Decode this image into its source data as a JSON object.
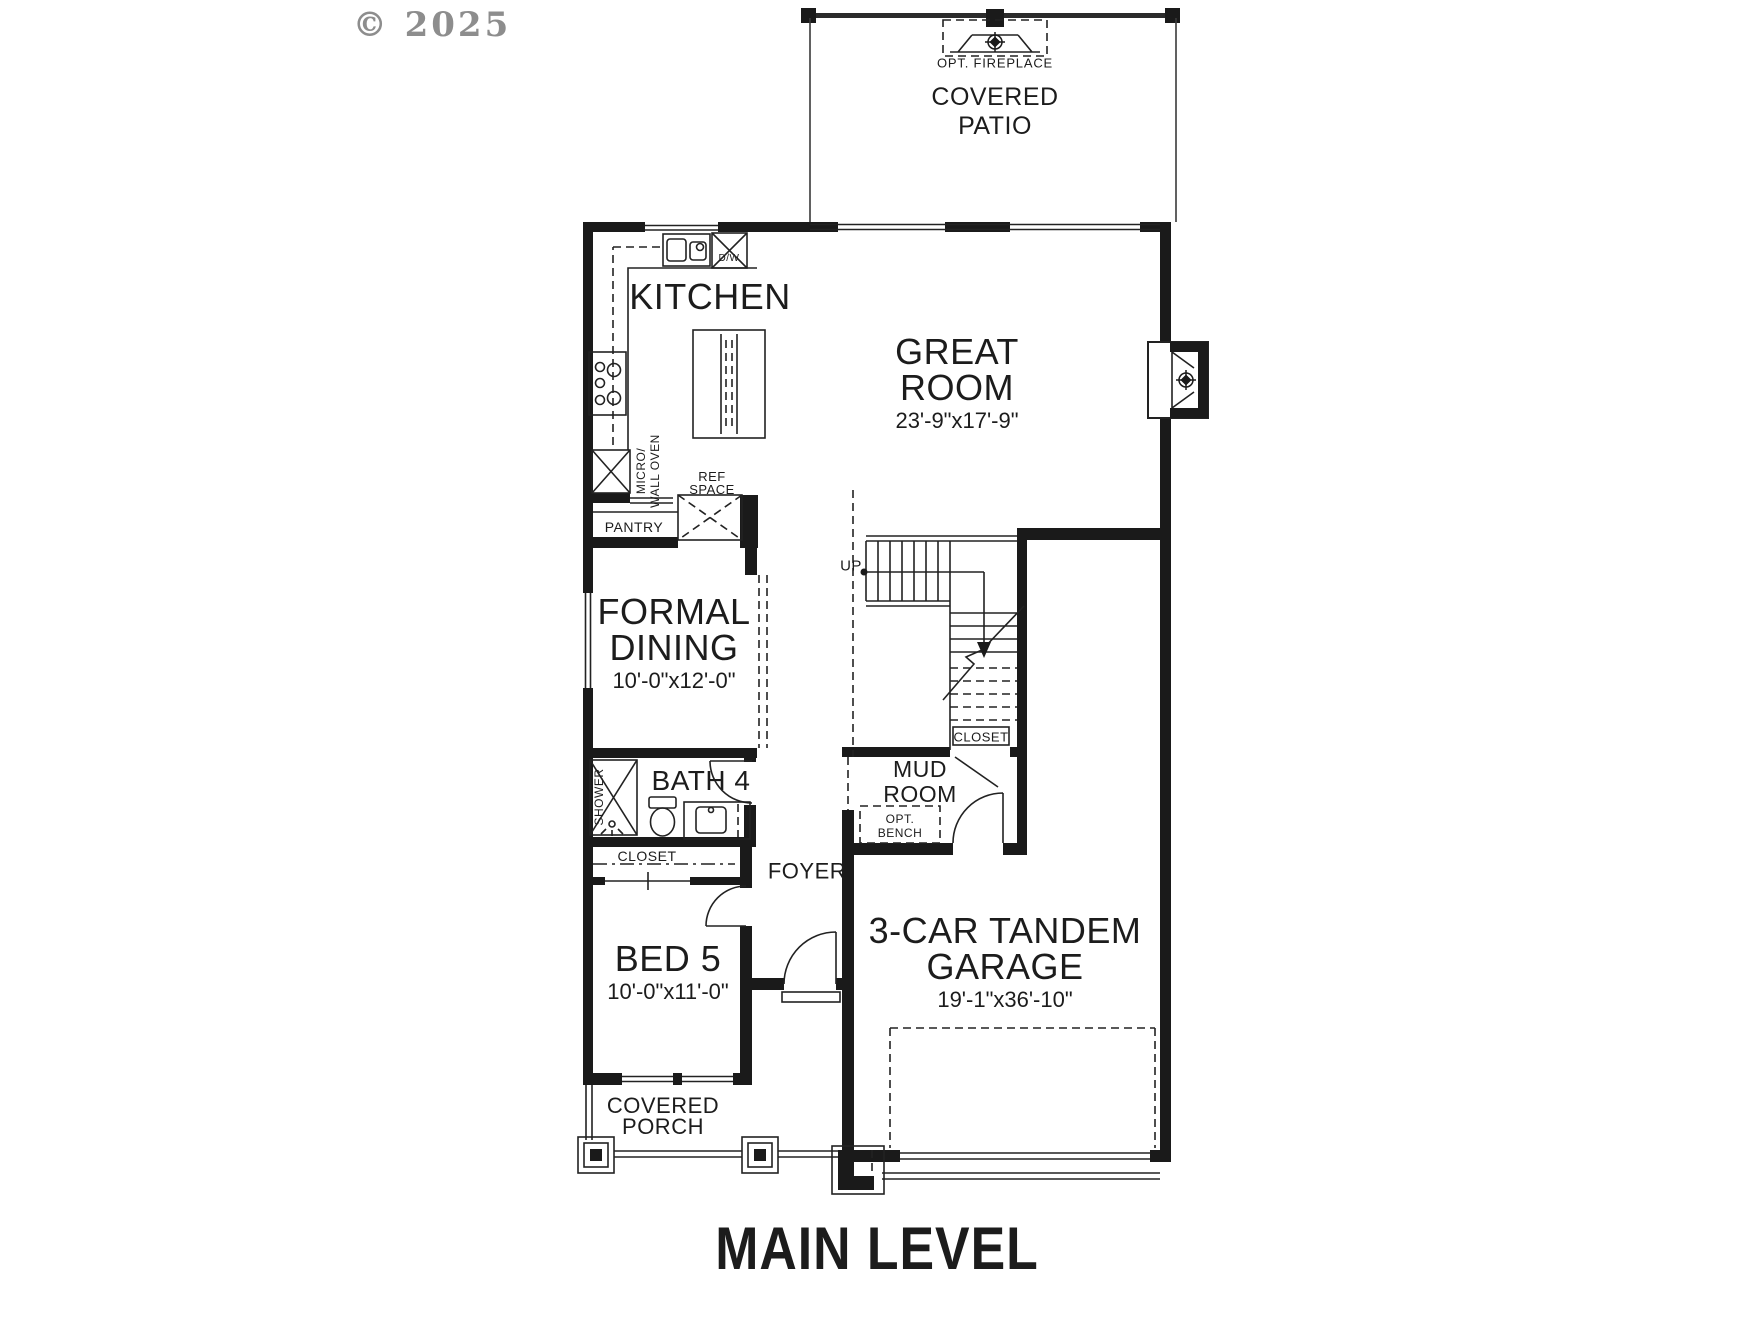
{
  "watermark": "© 2025",
  "plan_title": "MAIN LEVEL",
  "colors": {
    "line": "#1c1c1c",
    "watermark": "#8d8d8d",
    "background": "#ffffff"
  },
  "rooms": {
    "covered_patio": {
      "line1": "COVERED",
      "line2": "PATIO"
    },
    "opt_fireplace": {
      "label": "OPT. FIREPLACE"
    },
    "kitchen": {
      "name": "KITCHEN"
    },
    "great_room": {
      "line1": "GREAT",
      "line2": "ROOM",
      "dims": "23'-9\"x17'-9\""
    },
    "formal_dining": {
      "line1": "FORMAL",
      "line2": "DINING",
      "dims": "10'-0\"x12'-0\""
    },
    "bath4": {
      "name": "BATH 4"
    },
    "bed5": {
      "name": "BED 5",
      "dims": "10'-0\"x11'-0\""
    },
    "garage": {
      "line1": "3-CAR TANDEM",
      "line2": "GARAGE",
      "dims": "19'-1\"x36'-10\""
    },
    "mud_room": {
      "line1": "MUD",
      "line2": "ROOM"
    },
    "foyer": {
      "name": "FOYER"
    },
    "covered_porch": {
      "line1": "COVERED",
      "line2": "PORCH"
    }
  },
  "labels": {
    "up": "UP",
    "pantry": "PANTRY",
    "ref_line1": "REF",
    "ref_line2": "SPACE",
    "dishwasher": "D/W",
    "micro_line1": "MICRO/",
    "micro_line2": "WALL OVEN",
    "shower": "SHOWER",
    "closet_bed5": "CLOSET",
    "closet_stairs": "CLOSET",
    "bench_line1": "OPT.",
    "bench_line2": "BENCH"
  }
}
